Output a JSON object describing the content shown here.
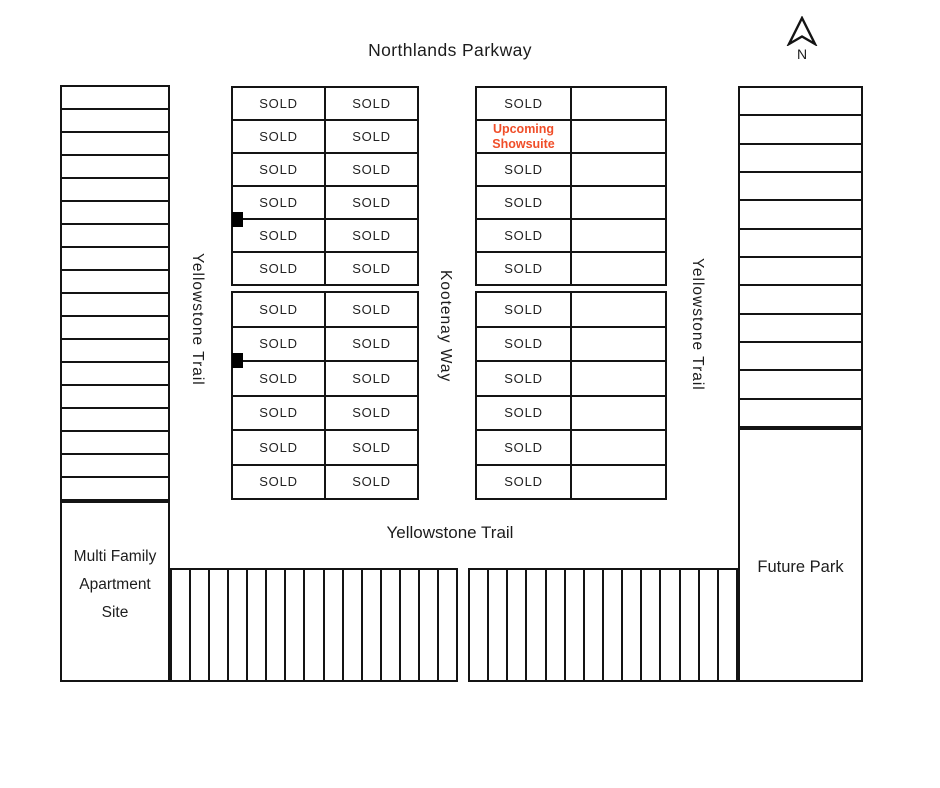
{
  "title": "Northlands Parkway",
  "compass": {
    "label": "N"
  },
  "streets": {
    "west_vertical": "Yellowstone Trail",
    "center_vertical": "Kootenay Way",
    "east_vertical": "Yellowstone Trail",
    "south_horizontal": "Yellowstone Trail"
  },
  "areas": {
    "multi_family": {
      "lines": [
        "Multi Family",
        "Apartment",
        "Site"
      ]
    },
    "future_park": {
      "label": "Future Park"
    }
  },
  "lot_status": {
    "sold": "SOLD",
    "upcoming_showsuite": "Upcoming Showsuite"
  },
  "colors": {
    "ink": "#141414",
    "accent": "#F04E29",
    "background": "#FFFFFF"
  },
  "blocks": {
    "west_lane": {
      "rows": 18
    },
    "east_lane": {
      "rows": 12
    },
    "center_west": {
      "rows_per_group": 6,
      "west_column": [
        "SOLD",
        "SOLD",
        "SOLD",
        "SOLD",
        "SOLD",
        "SOLD",
        "SOLD",
        "SOLD",
        "SOLD",
        "SOLD",
        "SOLD",
        "SOLD"
      ],
      "east_column": [
        "SOLD",
        "SOLD",
        "SOLD",
        "SOLD",
        "SOLD",
        "SOLD",
        "SOLD",
        "SOLD",
        "SOLD",
        "SOLD",
        "SOLD",
        "SOLD"
      ],
      "marker_count": 2
    },
    "center_east": {
      "rows_per_group": 6,
      "west_column": [
        "SOLD",
        "Upcoming Showsuite",
        "SOLD",
        "SOLD",
        "SOLD",
        "SOLD",
        "SOLD",
        "SOLD",
        "SOLD",
        "SOLD",
        "SOLD",
        "SOLD"
      ],
      "east_column": [
        "",
        "",
        "",
        "",
        "",
        "",
        "",
        "",
        "",
        "",
        "",
        ""
      ]
    },
    "south_west_row": {
      "cells": 15
    },
    "south_east_row": {
      "cells": 14
    }
  }
}
